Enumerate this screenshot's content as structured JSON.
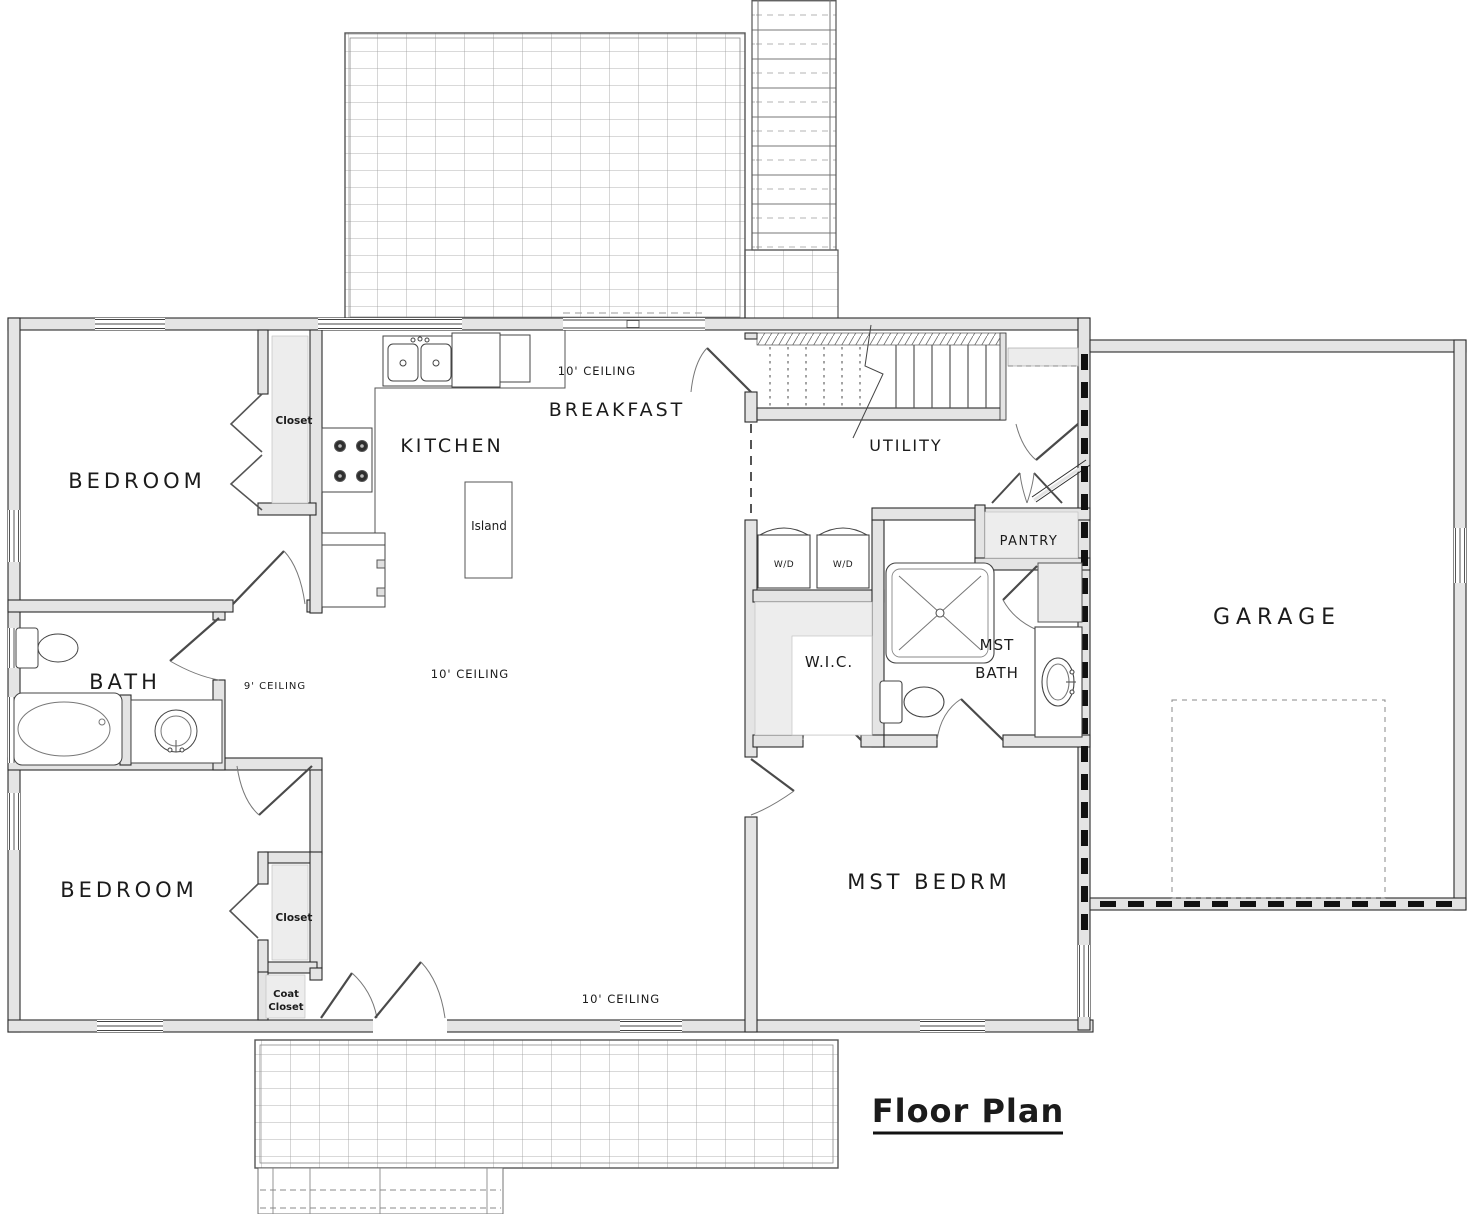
{
  "title": {
    "label": "Floor Plan"
  },
  "rooms": {
    "bedroom_top": "BEDROOM",
    "bedroom_bottom": "BEDROOM",
    "bath": "BATH",
    "kitchen": "KITCHEN",
    "breakfast": "BREAKFAST",
    "utility": "UTILITY",
    "pantry": "PANTRY",
    "garage": "GARAGE",
    "wic": "W.I.C.",
    "mst_bath_line1": "MST",
    "mst_bath_line2": "BATH",
    "mst_bedroom": "MST BEDRM",
    "closet_top": "Closet",
    "closet_bottom": "Closet",
    "coat_closet_line1": "Coat",
    "coat_closet_line2": "Closet",
    "island": "Island",
    "washer_dryer": "W/D"
  },
  "notes": {
    "ceiling_10": "10' CEILING",
    "ceiling_9": "9' CEILING"
  },
  "colors": {
    "wall_fill": "#e4e4e4",
    "wall_line": "#2b2b2b",
    "deck_line": "#9a9a9a",
    "shade_fill": "#ededed",
    "text": "#1b1b1b",
    "background": "#ffffff"
  }
}
